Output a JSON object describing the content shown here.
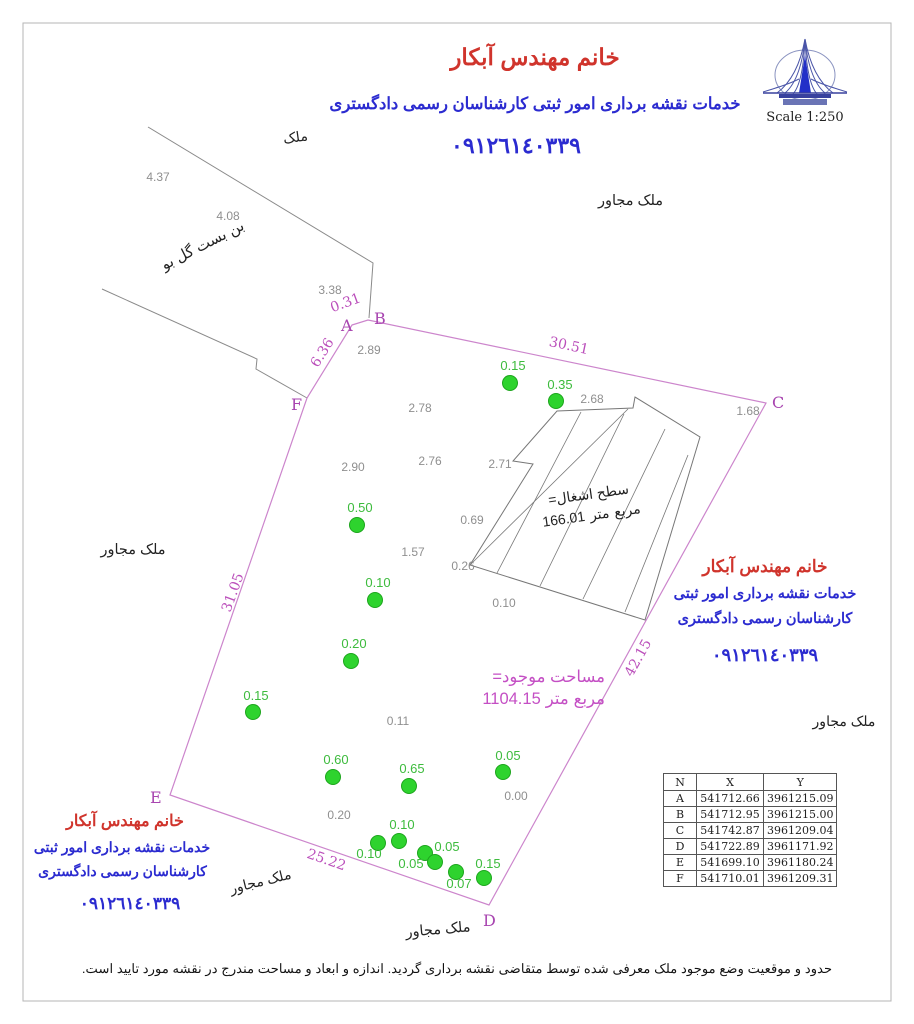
{
  "header": {
    "title": "خانم مهندس آبکار",
    "subtitle": "خدمات نقشه برداری امور ثبتی کارشناسان رسمی دادگستری",
    "phone": "٠٩١٢٦١٤٠٣٣٩",
    "scale_label": "Scale  1:250"
  },
  "right_block": {
    "title": "خانم مهندس آبکار",
    "line1": "خدمات نقشه برداری امور ثبتی",
    "line2": "کارشناسان رسمی دادگستری",
    "phone": "٠٩١٢٦١٤٠٣٣٩",
    "neighbor": "ملک مجاور"
  },
  "left_block": {
    "title": "خانم مهندس آبکار",
    "line1": "خدمات نقشه برداری امور ثبتی",
    "line2": "کارشناسان رسمی دادگستری",
    "phone": "٠٩١٢٦١٤٠٣٣٩",
    "neighbor": "ملک مجاور"
  },
  "labels": {
    "top_parcel": "ملک",
    "alley": "بن بست گل بو",
    "top_right_neighbor": "ملک مجاور",
    "left_neighbor": "ملک مجاور",
    "bottom_neighbor": "ملک مجاور"
  },
  "area_text": {
    "line1": "مساحت موجود=",
    "value": "1104.15",
    "unit_words": [
      "متر",
      "مربع"
    ]
  },
  "building_text": {
    "line1": "سطح اشغال=",
    "value": "166.01",
    "unit_words": [
      "متر",
      "مربع"
    ]
  },
  "footer_note": "حدود و موقعیت وضع موجود ملک معرفی شده توسط متقاضی نقشه برداری گردید. اندازه و ابعاد و مساحت مندرج در نقشه مورد تایید است.",
  "coords_table": {
    "headers": [
      "N",
      "X",
      "Y"
    ],
    "rows": [
      [
        "A",
        "541712.66",
        "3961215.09"
      ],
      [
        "B",
        "541712.95",
        "3961215.00"
      ],
      [
        "C",
        "541742.87",
        "3961209.04"
      ],
      [
        "D",
        "541722.89",
        "3961171.92"
      ],
      [
        "E",
        "541699.10",
        "3961180.24"
      ],
      [
        "F",
        "541710.01",
        "3961209.31"
      ]
    ]
  },
  "survey": {
    "frame": {
      "x": 23,
      "y": 23,
      "w": 868,
      "h": 978
    },
    "boundary_vertices": [
      {
        "name": "A",
        "x": 352,
        "y": 325,
        "lx": 341,
        "ly": 331
      },
      {
        "name": "B",
        "x": 368,
        "y": 320,
        "lx": 374,
        "ly": 324
      },
      {
        "name": "C",
        "x": 766,
        "y": 403,
        "lx": 772,
        "ly": 408
      },
      {
        "name": "D",
        "x": 489,
        "y": 905,
        "lx": 483,
        "ly": 926
      },
      {
        "name": "E",
        "x": 170,
        "y": 795,
        "lx": 150,
        "ly": 803
      },
      {
        "name": "F",
        "x": 307,
        "y": 398,
        "lx": 291,
        "ly": 410
      }
    ],
    "edge_labels": [
      {
        "text": "0.31",
        "x": 347,
        "y": 307,
        "rot": -20
      },
      {
        "text": "30.51",
        "x": 568,
        "y": 350,
        "rot": 12
      },
      {
        "text": "42.15",
        "x": 642,
        "y": 660,
        "rot": -61
      },
      {
        "text": "25.22",
        "x": 325,
        "y": 864,
        "rot": 19
      },
      {
        "text": "31.05",
        "x": 237,
        "y": 594,
        "rot": -70
      },
      {
        "text": "6.36",
        "x": 326,
        "y": 355,
        "rot": -58
      }
    ],
    "neighbor_lines": [
      [
        [
          148,
          127
        ],
        [
          373,
          263
        ],
        [
          369,
          318
        ]
      ],
      [
        [
          102,
          289
        ],
        [
          257,
          359
        ],
        [
          256,
          369
        ],
        [
          307,
          398
        ]
      ]
    ],
    "building": {
      "outline": "M557,411 L633,408 L635,397 L700,437 L645,620 L470,565 L533,464 L513,461 Z",
      "hatch": [
        [
          470,
          565,
          628,
          409
        ],
        [
          497,
          573,
          581,
          412
        ],
        [
          540,
          586,
          624,
          414
        ],
        [
          583,
          599,
          665,
          429
        ],
        [
          625,
          612,
          688,
          455
        ]
      ]
    },
    "spot_heights": [
      {
        "v": "0.15",
        "x": 510,
        "y": 383,
        "lx": 513,
        "ly": 370
      },
      {
        "v": "0.35",
        "x": 556,
        "y": 401,
        "lx": 560,
        "ly": 389
      },
      {
        "v": "0.50",
        "x": 357,
        "y": 525,
        "lx": 360,
        "ly": 512
      },
      {
        "v": "0.10",
        "x": 375,
        "y": 600,
        "lx": 378,
        "ly": 587
      },
      {
        "v": "0.20",
        "x": 351,
        "y": 661,
        "lx": 354,
        "ly": 648
      },
      {
        "v": "0.15",
        "x": 253,
        "y": 712,
        "lx": 256,
        "ly": 700
      },
      {
        "v": "0.60",
        "x": 333,
        "y": 777,
        "lx": 336,
        "ly": 764
      },
      {
        "v": "0.65",
        "x": 409,
        "y": 786,
        "lx": 412,
        "ly": 773
      },
      {
        "v": "0.05",
        "x": 503,
        "y": 772,
        "lx": 508,
        "ly": 760
      },
      {
        "v": "0.10",
        "x": 399,
        "y": 841,
        "lx": 402,
        "ly": 829
      },
      {
        "v": "0.10",
        "x": 378,
        "y": 843,
        "lx": 369,
        "ly": 858
      },
      {
        "v": "0.05",
        "x": 425,
        "y": 853,
        "lx": 447,
        "ly": 851
      },
      {
        "v": "0.05",
        "x": 435,
        "y": 862,
        "lx": 411,
        "ly": 868
      },
      {
        "v": "0.07",
        "x": 456,
        "y": 872,
        "lx": 459,
        "ly": 888
      },
      {
        "v": "0.15",
        "x": 484,
        "y": 878,
        "lx": 488,
        "ly": 868
      }
    ],
    "misc_dims": [
      {
        "t": "4.37",
        "x": 158,
        "y": 181
      },
      {
        "t": "4.08",
        "x": 228,
        "y": 220
      },
      {
        "t": "3.38",
        "x": 330,
        "y": 294
      },
      {
        "t": "2.89",
        "x": 369,
        "y": 354
      },
      {
        "t": "2.78",
        "x": 420,
        "y": 412
      },
      {
        "t": "2.90",
        "x": 353,
        "y": 471
      },
      {
        "t": "2.76",
        "x": 430,
        "y": 465
      },
      {
        "t": "2.71",
        "x": 500,
        "y": 468
      },
      {
        "t": "2.68",
        "x": 592,
        "y": 403
      },
      {
        "t": "1.68",
        "x": 748,
        "y": 415
      },
      {
        "t": "0.69",
        "x": 472,
        "y": 524
      },
      {
        "t": "1.57",
        "x": 413,
        "y": 556
      },
      {
        "t": "0.26",
        "x": 463,
        "y": 570
      },
      {
        "t": "0.10",
        "x": 504,
        "y": 607
      },
      {
        "t": "0.11",
        "x": 398,
        "y": 725
      },
      {
        "t": "0.00",
        "x": 516,
        "y": 800
      },
      {
        "t": "0.20",
        "x": 339,
        "y": 819
      }
    ]
  }
}
